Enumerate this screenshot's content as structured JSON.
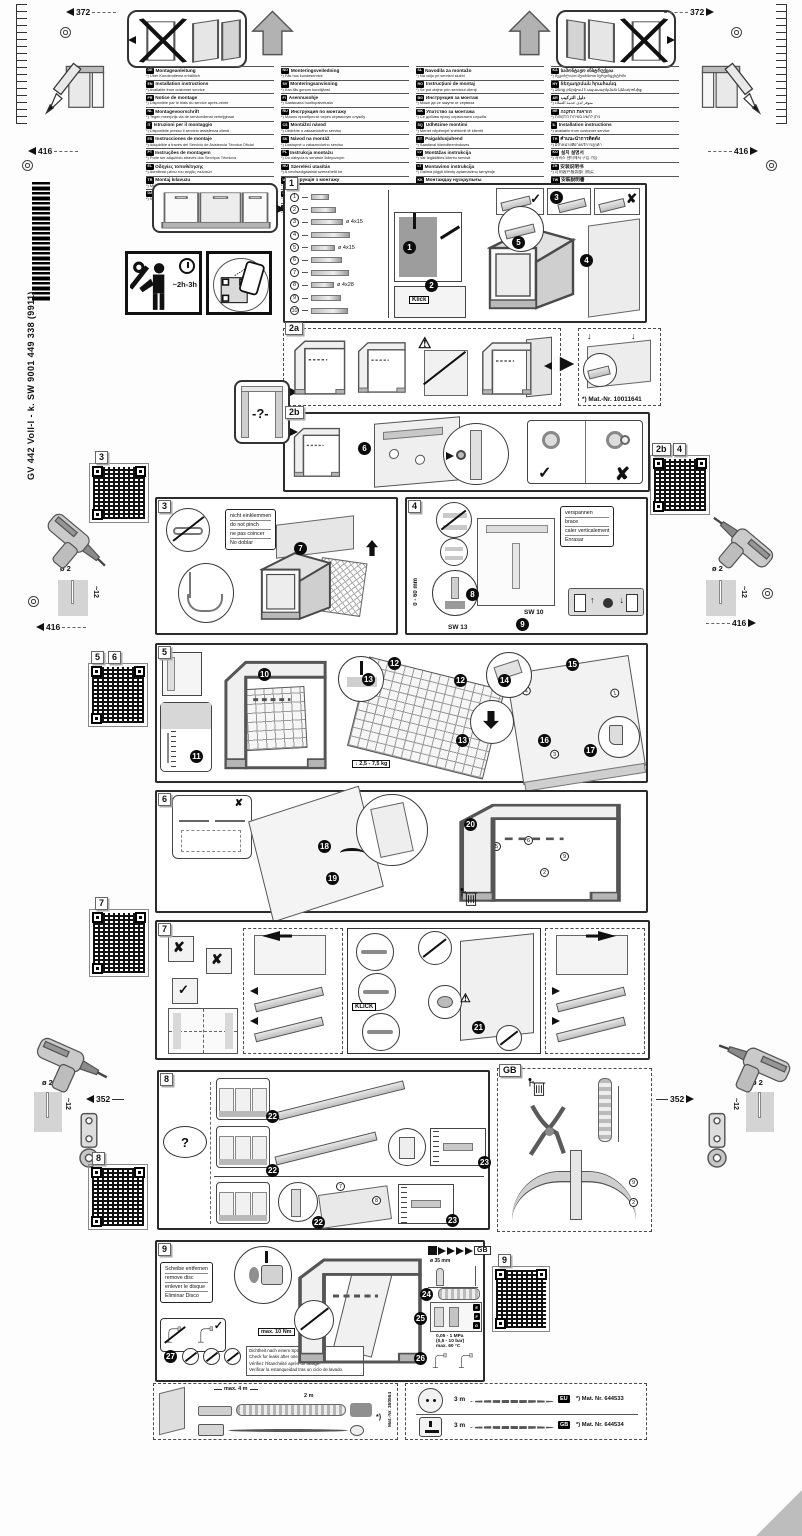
{
  "doc": {
    "part_code": "GV 442 Voll-I - k. SW  9001 449 338 (9911)",
    "dim_372": "372",
    "dim_416": "416",
    "dim_352": "352",
    "drill_dia": "ø 2",
    "drill_depth": "~12",
    "time_estimate": "~2h-3h"
  },
  "icons": {
    "check": "✓",
    "cross": "✘",
    "warn": "⚠",
    "question": "?",
    "niche_question": "-?-",
    "down_arrow": "↓",
    "asterisk": "*)"
  },
  "languages": {
    "col1": [
      {
        "code": "de",
        "title": "Montageanleitung",
        "note": "*) Über Kundendienst erhältlich"
      },
      {
        "code": "en",
        "title": "Installation instructions",
        "note": "*) Available from customer service"
      },
      {
        "code": "fr",
        "title": "Notice de montage",
        "note": "*) Disponible par le biais du service après-vente"
      },
      {
        "code": "nl",
        "title": "Montagevoorschrift",
        "note": "*) Tegen meerprijs via de servicedienst verkrijgbaar"
      },
      {
        "code": "it",
        "title": "Istruzioni per il montaggio",
        "note": "*) Disponibile presso il servizio assistenza clienti"
      },
      {
        "code": "es",
        "title": "Instrucciones de montaje",
        "note": "*) Adquirible a través del Servicio de Asistencia Técnica Oficial"
      },
      {
        "code": "pt",
        "title": "Instruções de montagem",
        "note": "*) Pode ser adquirido através dos Serviços Técnicos"
      },
      {
        "code": "el",
        "title": "Οδηγίες τοποθέτησης",
        "note": "*) Διατίθεται μέσω του σέρβις πελατών"
      },
      {
        "code": "tr",
        "title": "Montaj kılavuzu",
        "note": "*) Müşteri hizmetlerinden temin edilebilir"
      },
      {
        "code": "da",
        "title": "Monteringsvejledning",
        "note": "*) Kan fås via service"
      }
    ],
    "col2": [
      {
        "code": "no",
        "title": "Monteringsveiledning",
        "note": "*) Fås hos kundeservice"
      },
      {
        "code": "sv",
        "title": "Monteringsanvisning",
        "note": "*) Kan fås genom kundtjänst"
      },
      {
        "code": "fi",
        "title": "Asennusohje",
        "note": "*) Saatavana huoltopalvelusta"
      },
      {
        "code": "ru",
        "title": "Инструкция по монтажу",
        "note": "*) Можно приобрести через сервисную службу"
      },
      {
        "code": "cs",
        "title": "Montážní návod",
        "note": "*) Obdržíte u zákaznického servisu"
      },
      {
        "code": "sk",
        "title": "Návod na montáž",
        "note": "*) Dostupné u zákazníckeho servisu"
      },
      {
        "code": "pl",
        "title": "Instrukcja montażu",
        "note": "*) Do nabycia w serwisie fabrycznym"
      },
      {
        "code": "hu",
        "title": "Szerelési utasítás",
        "note": "*) A vevőszolgálatnál szerezhető be"
      },
      {
        "code": "uk",
        "title": "Інструкція з монтажу",
        "note": "*) Можна придбати через сервісну службу"
      },
      {
        "code": "hr",
        "title": "Upute za montažu",
        "note": "*) Mogu se dobiti kod servisne službe"
      },
      {
        "code": "sr",
        "title": "Uputstvo za montažu",
        "note": "*) Može se nabaviti preko servisne službe"
      }
    ],
    "col3": [
      {
        "code": "sl",
        "title": "Navodila za montažo",
        "note": "*) Na voljo pri servisni službi"
      },
      {
        "code": "ro",
        "title": "Instrucţiuni de montaj",
        "note": "*) Se pot obţine prin serviciul clienţi"
      },
      {
        "code": "bg",
        "title": "Инструкция за монтаж",
        "note": "*) Може да се закупи от сервиза"
      },
      {
        "code": "mk",
        "title": "Упатство за монтажа",
        "note": "*) Се добива преку сервисната служба"
      },
      {
        "code": "sq",
        "title": "Udhëzime montimi",
        "note": "*) Merret nëpërmjet shërbimit të klientit"
      },
      {
        "code": "et",
        "title": "Paigaldusjuhend",
        "note": "*) Saadaval klienditeeninduses"
      },
      {
        "code": "lv",
        "title": "Montāžas instrukcija",
        "note": "*) Var iegādāties klientu servisā"
      },
      {
        "code": "lt",
        "title": "Montavimo instrukcija",
        "note": "*) Galima įsigyti klientų aptarnavimo tarnyboje"
      },
      {
        "code": "kk",
        "title": "Монтаждау нұсқаулығы",
        "note": "*) Қызмет көрсету орталығынан алуға болады"
      },
      {
        "code": "az",
        "title": "Quraşdırma təlimatı",
        "note": "*) Müştəri xidmətindən əldə edilə bilər"
      }
    ],
    "col4": [
      {
        "code": "ka",
        "title": "სამონტაჟო ინსტრუქცია",
        "note": "*) შეგიძლიათ შეიძინოთ სერვისცენტრში"
      },
      {
        "code": "hy",
        "title": "Տեղադրման հրահանգ",
        "note": "*) Ձեռք բերվում է սպասարկման կենտրոնից"
      },
      {
        "code": "ar",
        "title": "دليل التركيب",
        "note": "*) متوفر لدى خدمة العملاء"
      },
      {
        "code": "he",
        "title": "הוראות התקנה",
        "note": "*) ניתן להשיג בשירות הלקוחות"
      },
      {
        "code": "il",
        "title": "Installation instructions",
        "note": "*) available from customer service"
      },
      {
        "code": "th",
        "title": "คำแนะนำการติดตั้ง",
        "note": "*) มีจำหน่ายที่ฝ่ายบริการลูกค้า"
      },
      {
        "code": "ko",
        "title": "설치 설명서",
        "note": "*) 서비스 센터에서 구입 가능"
      },
      {
        "code": "zh",
        "title": "安装说明书",
        "note": "*) 可向客户服务部门购买"
      },
      {
        "code": "tw",
        "title": "安裝說明書",
        "note": "*) 可向客戶服務部門購買"
      }
    ]
  },
  "steps": {
    "s1": "1",
    "s2": "2",
    "s3": "3",
    "s4": "4",
    "s5": "5",
    "s6": "6",
    "s7": "7",
    "s8": "8",
    "s9": "9",
    "s10": "10",
    "s11": "11",
    "s12": "12",
    "s13": "13",
    "s14": "14",
    "s15": "15",
    "s16": "16",
    "s17": "17",
    "s18": "18",
    "s19": "19",
    "s20": "20",
    "s21": "21",
    "s22": "22",
    "s23": "23",
    "s24": "24",
    "s25": "25",
    "s26": "26",
    "s27": "27"
  },
  "p1": {
    "label": "1",
    "klick": "Klick",
    "parts": [
      {
        "n": "1",
        "label": ""
      },
      {
        "n": "2",
        "label": ""
      },
      {
        "n": "3",
        "label": "ø 4x15"
      },
      {
        "n": "4",
        "label": ""
      },
      {
        "n": "5",
        "label": "ø 4x15"
      },
      {
        "n": "6",
        "label": ""
      },
      {
        "n": "7",
        "label": ""
      },
      {
        "n": "8",
        "label": "ø 4x28"
      },
      {
        "n": "9",
        "label": ""
      },
      {
        "n": "10",
        "label": ""
      }
    ]
  },
  "p2a": {
    "label": "2a",
    "mat_nr": "*) Mat.-Nr. 10011641"
  },
  "p2b": {
    "label": "2b"
  },
  "p3": {
    "label": "3",
    "note": [
      "nicht einklemmen",
      "do not pinch",
      "ne pas coincer",
      "No doblar"
    ]
  },
  "p4": {
    "label": "4",
    "note": [
      "verspannen",
      "brace",
      "caler verticalement",
      "Enrasar"
    ],
    "range": "0 - 60 mm",
    "sw13": "SW 13",
    "sw10": "SW 10"
  },
  "p5": {
    "label": "5",
    "weight": "2,5 - 7,5 kg"
  },
  "p6": {
    "label": "6"
  },
  "p7": {
    "label": "7",
    "klick": "KLICK"
  },
  "p8": {
    "label": "8",
    "question": "?"
  },
  "gb_panel": {
    "label": "GB"
  },
  "p9": {
    "label": "9",
    "note": [
      "Scheibe entfernen",
      "remove disc",
      "enlever le disque",
      "Eliminar Disco"
    ],
    "torque": "max. 10 Nm",
    "leak": [
      "Dichtheit nach einem Spülgang prüfen.",
      "Check for leaks after one wash cycle.",
      "Vérifiez l'étanchéité après un lavage.",
      "Verificar la estanqueidad tras un ciclo de lavado."
    ],
    "drain_ref": "GB",
    "hole": "ø 35 mm",
    "pressure1": "0,05 - 1 MPa",
    "pressure2": "(0,5 - 10 bar)",
    "temp": "max. 60 °C"
  },
  "accessories": {
    "hose": {
      "dim_total": "max. 4 m",
      "dim_2m": "2 m",
      "mat": "Mat.-Nr. 350564"
    },
    "cords": [
      {
        "len": "3 m",
        "region": "EU",
        "mat": "*) Mat. Nr. 644533"
      },
      {
        "len": "3 m",
        "region": "GB",
        "mat": "*) Mat. Nr. 644534"
      }
    ]
  },
  "qr_labels": {
    "q1": "1",
    "q2b": "2b",
    "q4": "4",
    "q3": "3",
    "q5": "5",
    "q6": "6",
    "q7": "7",
    "q8": "8",
    "q9": "9"
  }
}
